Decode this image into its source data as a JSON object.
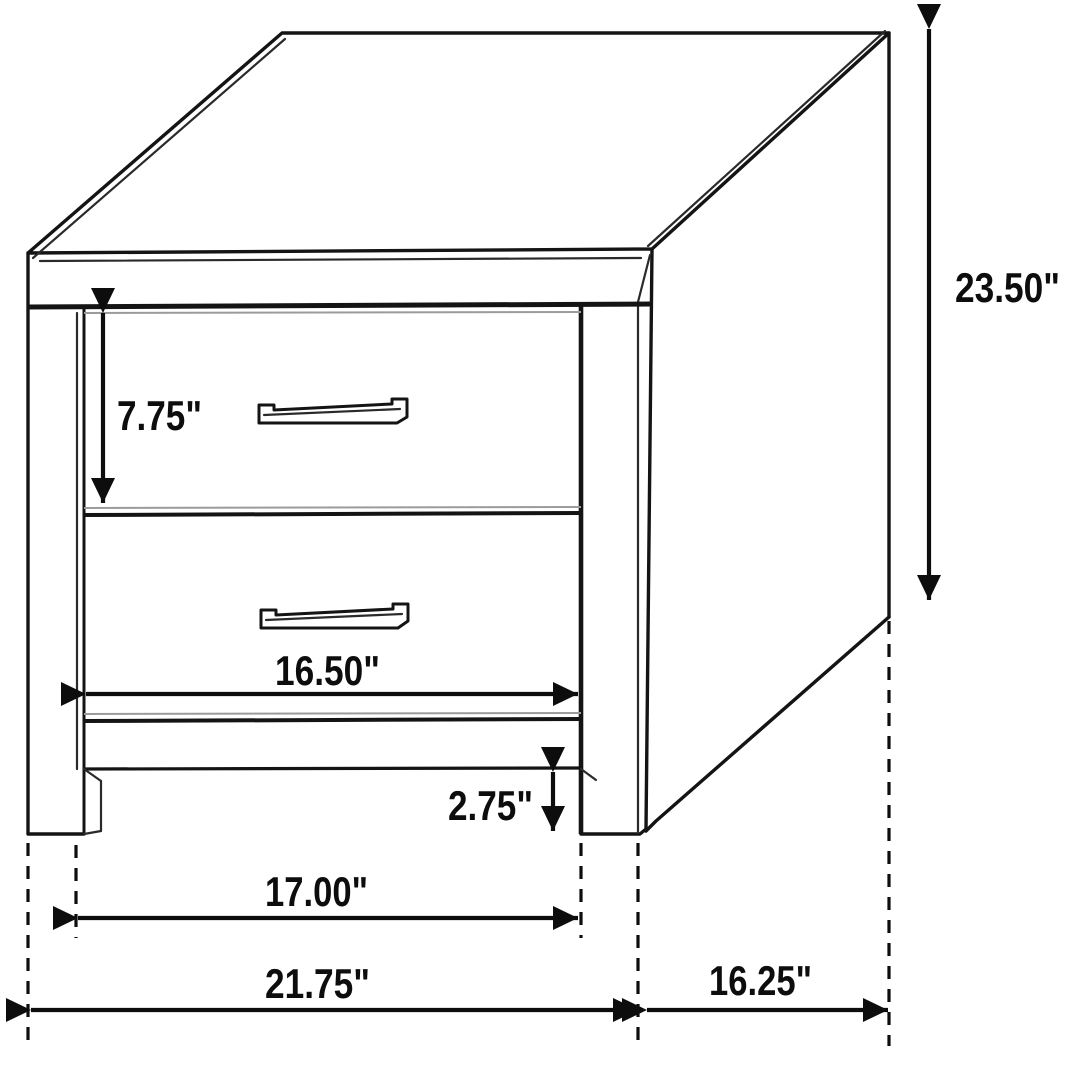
{
  "diagram": {
    "subject": "two-drawer-nightstand-technical-line-drawing",
    "unit": "inches",
    "colors": {
      "line": "#141414",
      "secondary_line": "#9b9b9b",
      "dimension_text": "#0d0d0d",
      "background": "#ffffff"
    },
    "dimensions": {
      "top_drawer_height": {
        "value": 7.75,
        "label": "7.75\""
      },
      "overall_height": {
        "value": 23.5,
        "label": "23.50\""
      },
      "drawer_opening_width": {
        "value": 16.5,
        "label": "16.50\""
      },
      "leg_height": {
        "value": 2.75,
        "label": "2.75\""
      },
      "inner_leg_span": {
        "value": 17.0,
        "label": "17.00\""
      },
      "overall_width": {
        "value": 21.75,
        "label": "21.75\""
      },
      "depth": {
        "value": 16.25,
        "label": "16.25\""
      }
    }
  }
}
